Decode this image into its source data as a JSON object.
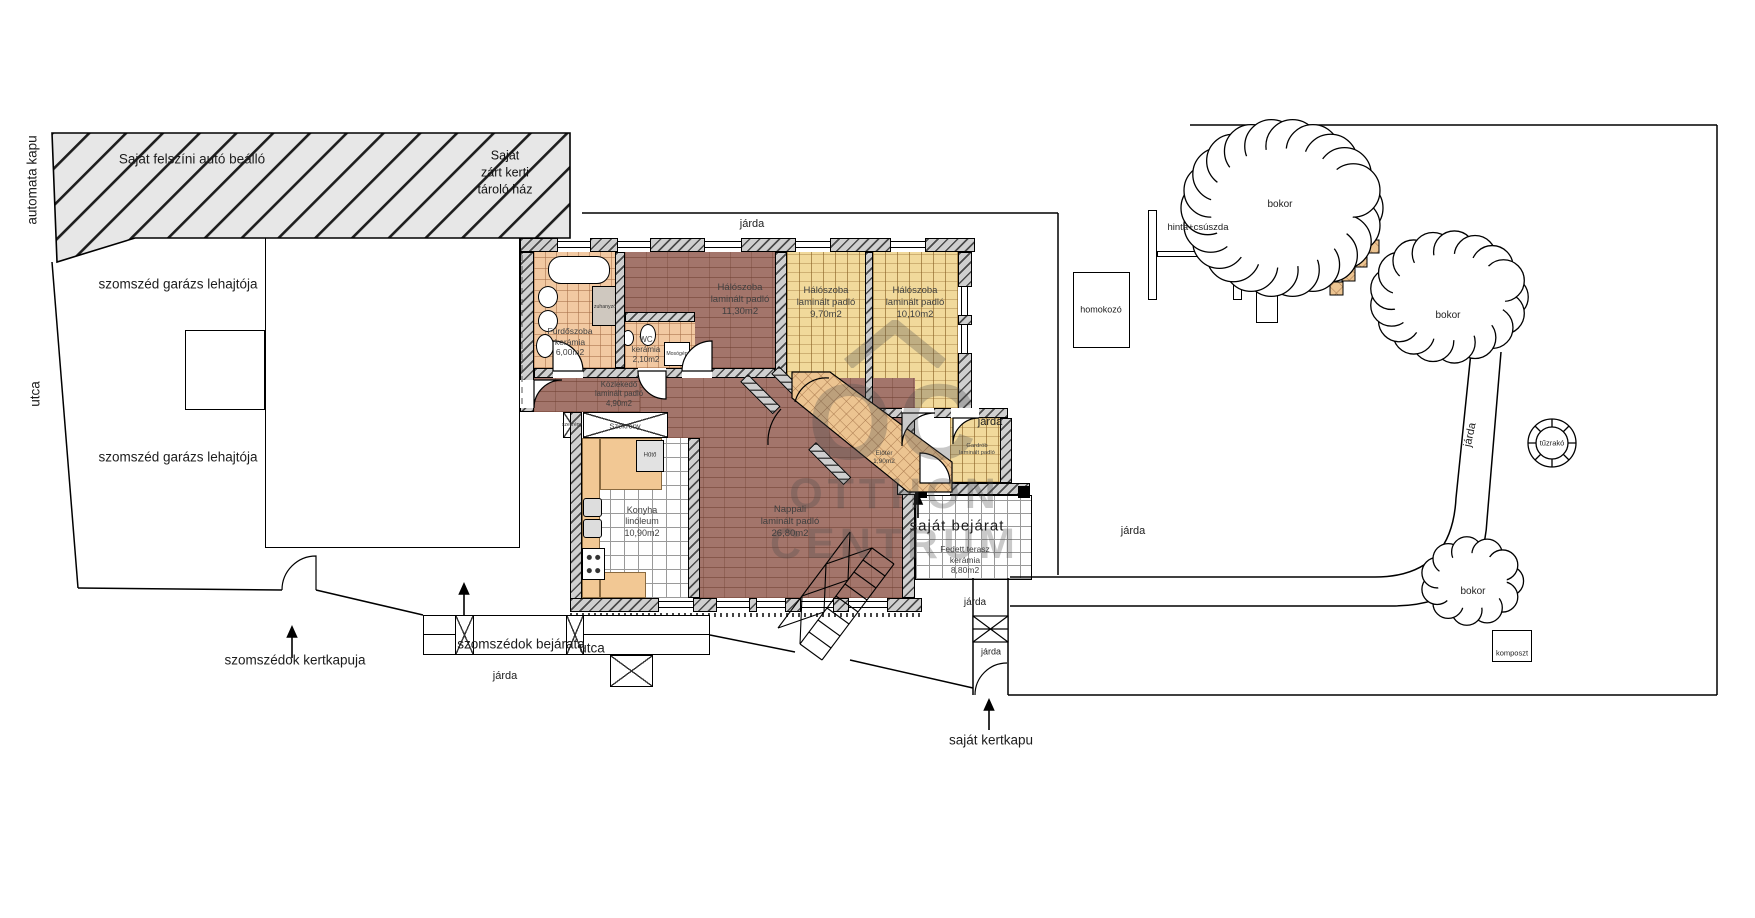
{
  "site": {
    "automata_kapu": "automata kapu",
    "carport": "Saját felszíni autó beálló",
    "storage_house": {
      "line1": "Saját",
      "line2": "zárt kerti",
      "line3": "tároló ház"
    },
    "neighbor_garage_ramp": "szomszéd garázs lehajtója",
    "street": "utca",
    "sidewalk": "járda",
    "neighbors_entrance": "szomszédok bejárata",
    "neighbors_garden_gate": "szomszédok kertkapuja",
    "own_garden_gate": "saját kertkapu",
    "own_entrance": "saját bejárat"
  },
  "rooms": {
    "bathroom": {
      "name": "Fürdőszoba",
      "floor": "kerámia",
      "area": "6,00m2"
    },
    "wc": {
      "name": "WC",
      "floor": "kerámia",
      "area": "2,10m2"
    },
    "bedroom1": {
      "name": "Hálószoba",
      "floor": "laminált padló",
      "area": "11,30m2"
    },
    "bedroom2": {
      "name": "Hálószoba",
      "floor": "laminált padló",
      "area": "9,70m2"
    },
    "bedroom3": {
      "name": "Hálószoba",
      "floor": "laminált padló",
      "area": "10,10m2"
    },
    "hall": {
      "name": "Közlekedő",
      "floor": "laminált padló",
      "area": "4,90m2"
    },
    "kitchen": {
      "name": "Konyha",
      "floor": "linóleum",
      "area": "10,90m2"
    },
    "living_room": {
      "name": "Nappali",
      "floor": "laminált padló",
      "area": "26,80m2"
    },
    "covered_terrace": {
      "name": "Fedett terasz",
      "floor": "kerámia",
      "area": "8,80m2"
    },
    "entry": {
      "name": "Előtér",
      "area": "1,90m2"
    },
    "closet_room": {
      "name": "Gardrób",
      "floor": "laminált padló"
    }
  },
  "fixtures": {
    "shower": "zuhanyzó",
    "washing_machine": "Mosógép",
    "fridge": "Hűtő",
    "wardrobe": "Szekrény",
    "wardrobe_small": "szekrény"
  },
  "garden": {
    "sandbox": "homokozó",
    "swing_slide": "hinta+csúszda",
    "bush": "bokor",
    "fire_pit": "tűzrakó",
    "compost": "komposzt"
  },
  "watermark": {
    "monogram": "OC",
    "line1": "OTTHON",
    "line2": "CENTRUM"
  }
}
